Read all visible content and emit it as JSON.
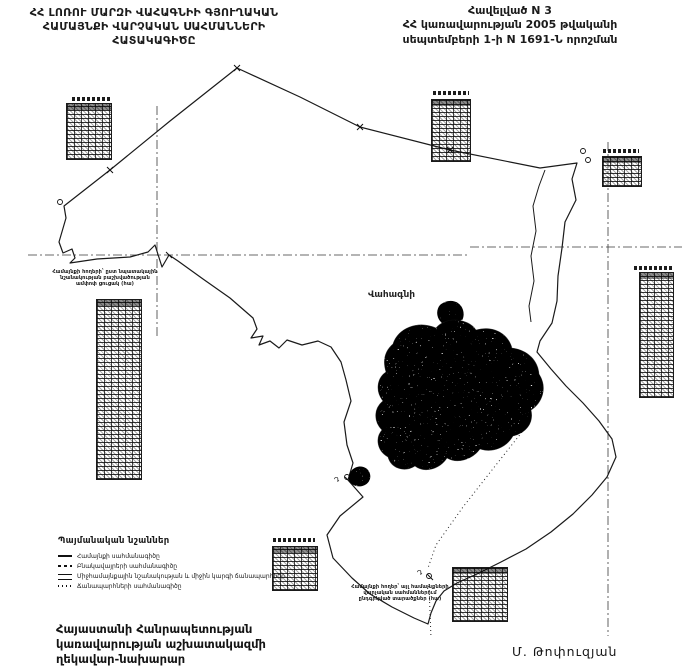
{
  "page": {
    "title_left": {
      "line1": "ՀՀ ԼՈՌՈՒ ՄԱՐԶԻ ՎԱՀԱԳՆԻԻ ԳՅՈՒՂԱԿԱՆ",
      "line2": "ՀԱՄԱՅՆՔԻ ՎԱՐՉԱԿԱՆ ՍԱՀՄԱՆՆԵՐԻ",
      "line3": "ՀԱՏԱԿԱԳԻԾԸ"
    },
    "annex": {
      "line1": "Հավելված N 3",
      "line2": "ՀՀ կառավարության 2005 թվականի",
      "line3": "սեպտեմբերի 1-ի N 1691-Ն  որոշման"
    }
  },
  "map": {
    "settlement_label": "Վահագնի",
    "markers": {
      "d1": "Դ",
      "d2": "Դ"
    },
    "left_table_caption": "Համայնքի հողերի՝ ըստ նպատակային նշանակության բաշխվածության ամփոփ ցուցակ (հա)",
    "bottom_caption": "Համայնքի հողեր՝ այլ համայնքների վարչական սահմաններում ընդգրկված տարածքներ (հա)"
  },
  "legend": {
    "title": "Պայմանական նշաններ",
    "items": [
      "Համայնքի սահմանագիծը",
      "Բնակավայրերի սահմանագիծը",
      "Միջհամայնքային նշանակության և միջին կարգի ճանապարհներ",
      "Ճանապարհների սահմանագիծը"
    ]
  },
  "footer": {
    "signature_line1": "Հայաստանի Հանրապետության",
    "signature_line2": "կառավարության աշխատակազմի",
    "signature_line3": "ղեկավար-նախարար",
    "signer": "Մ. Թոփուզյան"
  },
  "colors": {
    "ink": "#1b1b1b",
    "paper": "#ffffff"
  }
}
